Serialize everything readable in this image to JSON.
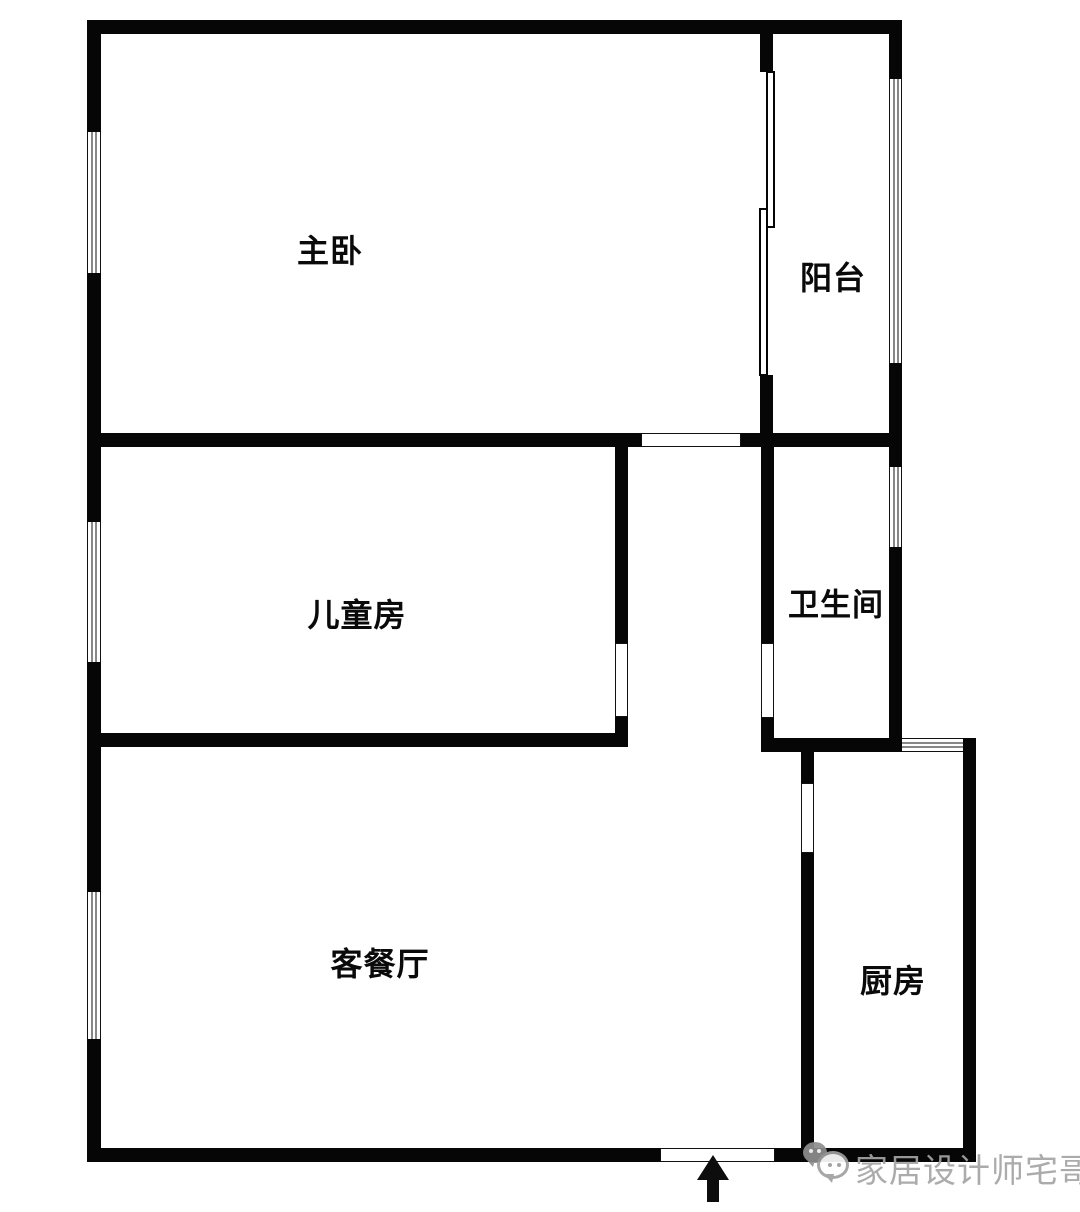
{
  "plan": {
    "type": "apartment-floor-plan",
    "colors": {
      "wall": "#060606",
      "background": "#ffffff",
      "watermark": "#a4a4a4"
    },
    "rooms": [
      {
        "id": "master-bedroom",
        "label": "主卧"
      },
      {
        "id": "balcony",
        "label": "阳台"
      },
      {
        "id": "children-room",
        "label": "儿童房"
      },
      {
        "id": "bathroom",
        "label": "卫生间"
      },
      {
        "id": "living-dining",
        "label": "客餐厅"
      },
      {
        "id": "kitchen",
        "label": "厨房"
      }
    ],
    "entrance": {
      "icon": "entrance-arrow"
    },
    "watermark": {
      "icon": "wechat-icon",
      "text": "家居设计师宅哥"
    }
  }
}
